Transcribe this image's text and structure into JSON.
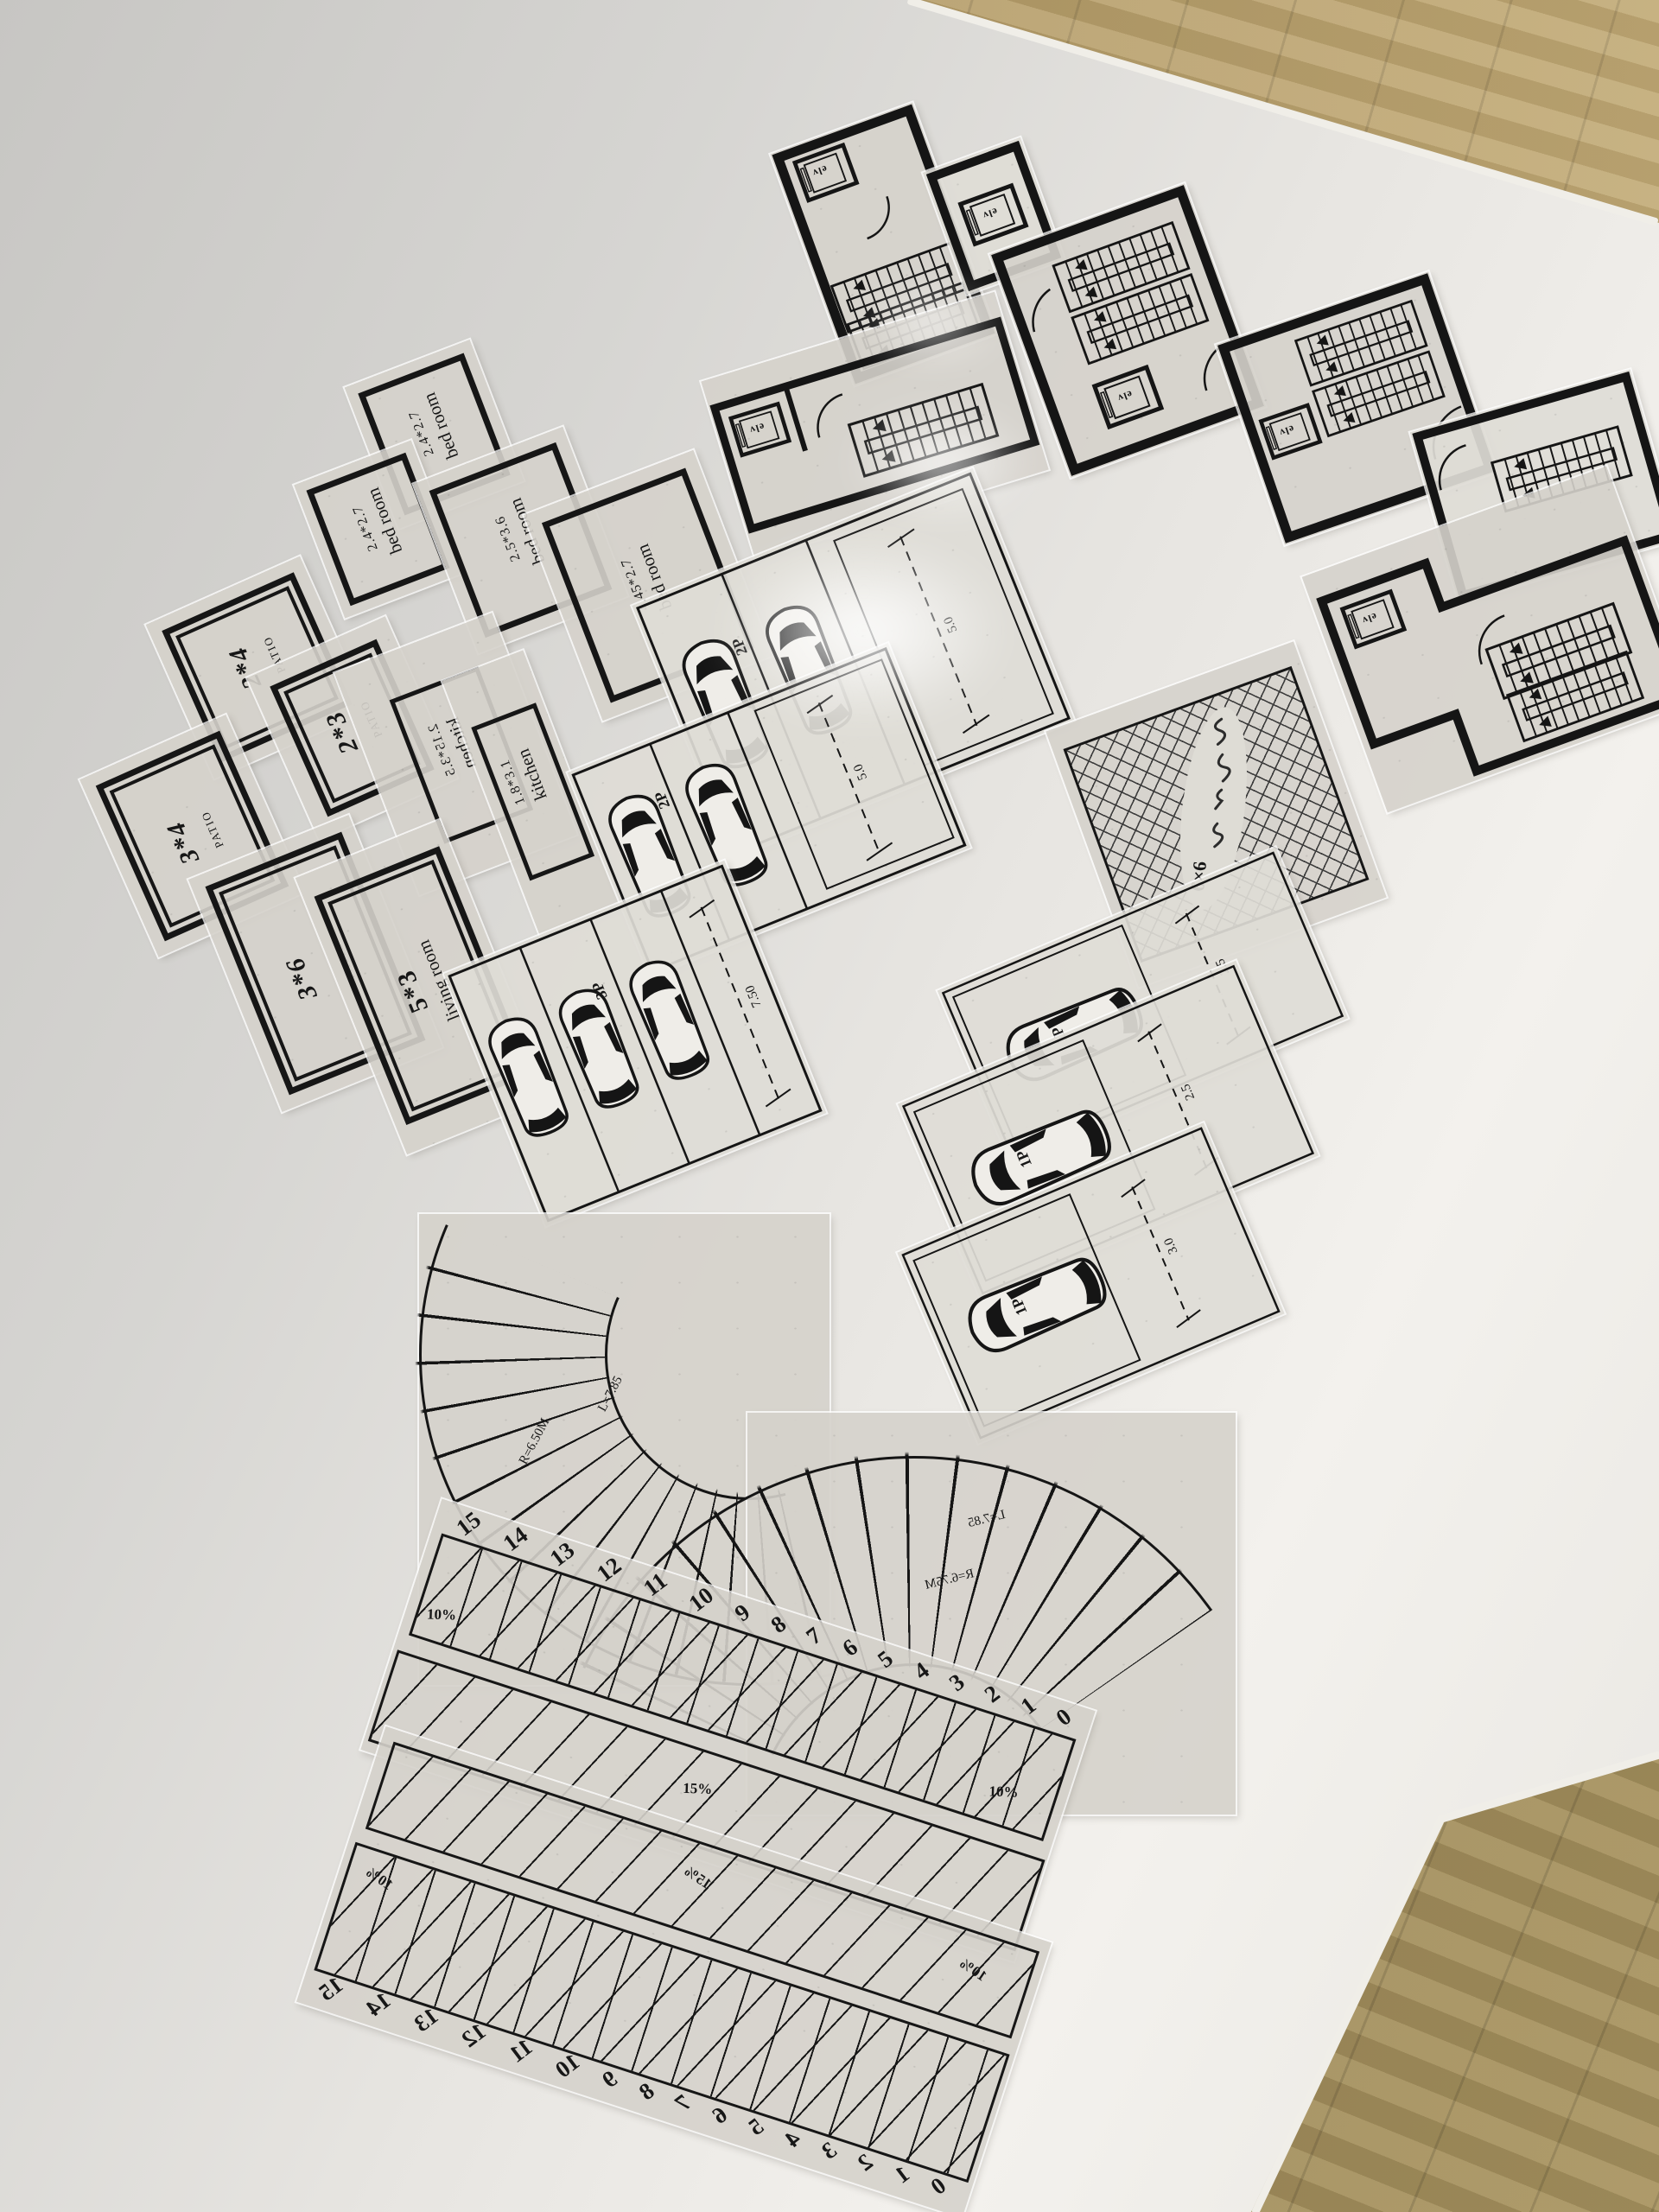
{
  "scene": {
    "table_color": "#e9e7e2",
    "sheet_color": "#d5d2cb",
    "ink_color": "#161616",
    "wood_light": "#b59c68",
    "wood_dark": "#8d7a50"
  },
  "stairs": {
    "elevator_label": "elv"
  },
  "rooms": {
    "bedroom_a": {
      "dims": "2.4*2.7",
      "name": "bed room"
    },
    "bedroom_b": {
      "dims": "2.4*2.7",
      "name": "bed room"
    },
    "bedroom_c": {
      "dims": "2.5*3.6",
      "name": "bed room"
    },
    "bedroom_d": {
      "dims": "4.45*2.7",
      "name": "bed room"
    },
    "patio_a": {
      "dims": "2*4",
      "name": "PATIO"
    },
    "patio_b": {
      "dims": "2*3",
      "name": "PATIO"
    },
    "patio_c": {
      "dims": "3*4",
      "name": "PATIO"
    },
    "patio_d": {
      "dims": "3*6",
      "name": "PATIO"
    },
    "kitchen_a": {
      "dims": "2.15*3.5",
      "name": "kitchen"
    },
    "kitchen_b": {
      "dims": "1.8*3.1",
      "name": "kitchen"
    },
    "living_room": {
      "dims": "5*3",
      "name": "living room"
    }
  },
  "parking": {
    "double_a": {
      "label": "2P",
      "dimension": "5.0"
    },
    "double_b": {
      "label": "2P",
      "dimension": "5.0"
    },
    "triple": {
      "label": "3P",
      "dimension": "7.50"
    },
    "single_a": {
      "label": "1P",
      "dimension": "2.5"
    },
    "single_b": {
      "label": "1P",
      "dimension": "2.5"
    },
    "single_c": {
      "label": "1P",
      "dimension": "3.0"
    }
  },
  "courtyard": {
    "note": "6×6"
  },
  "curved_stairs": {
    "left": {
      "radius": "R=6.50M",
      "arc_length": "L=7.85"
    },
    "right": {
      "radius": "R=6.75M",
      "arc_length": "L=7.85"
    }
  },
  "rulers": {
    "numbers": [
      "15",
      "14",
      "13",
      "12",
      "11",
      "10",
      "9",
      "8",
      "7",
      "6",
      "5",
      "4",
      "3",
      "2",
      "1",
      "0"
    ],
    "slope_low": "10%",
    "slope_high": "15%"
  }
}
